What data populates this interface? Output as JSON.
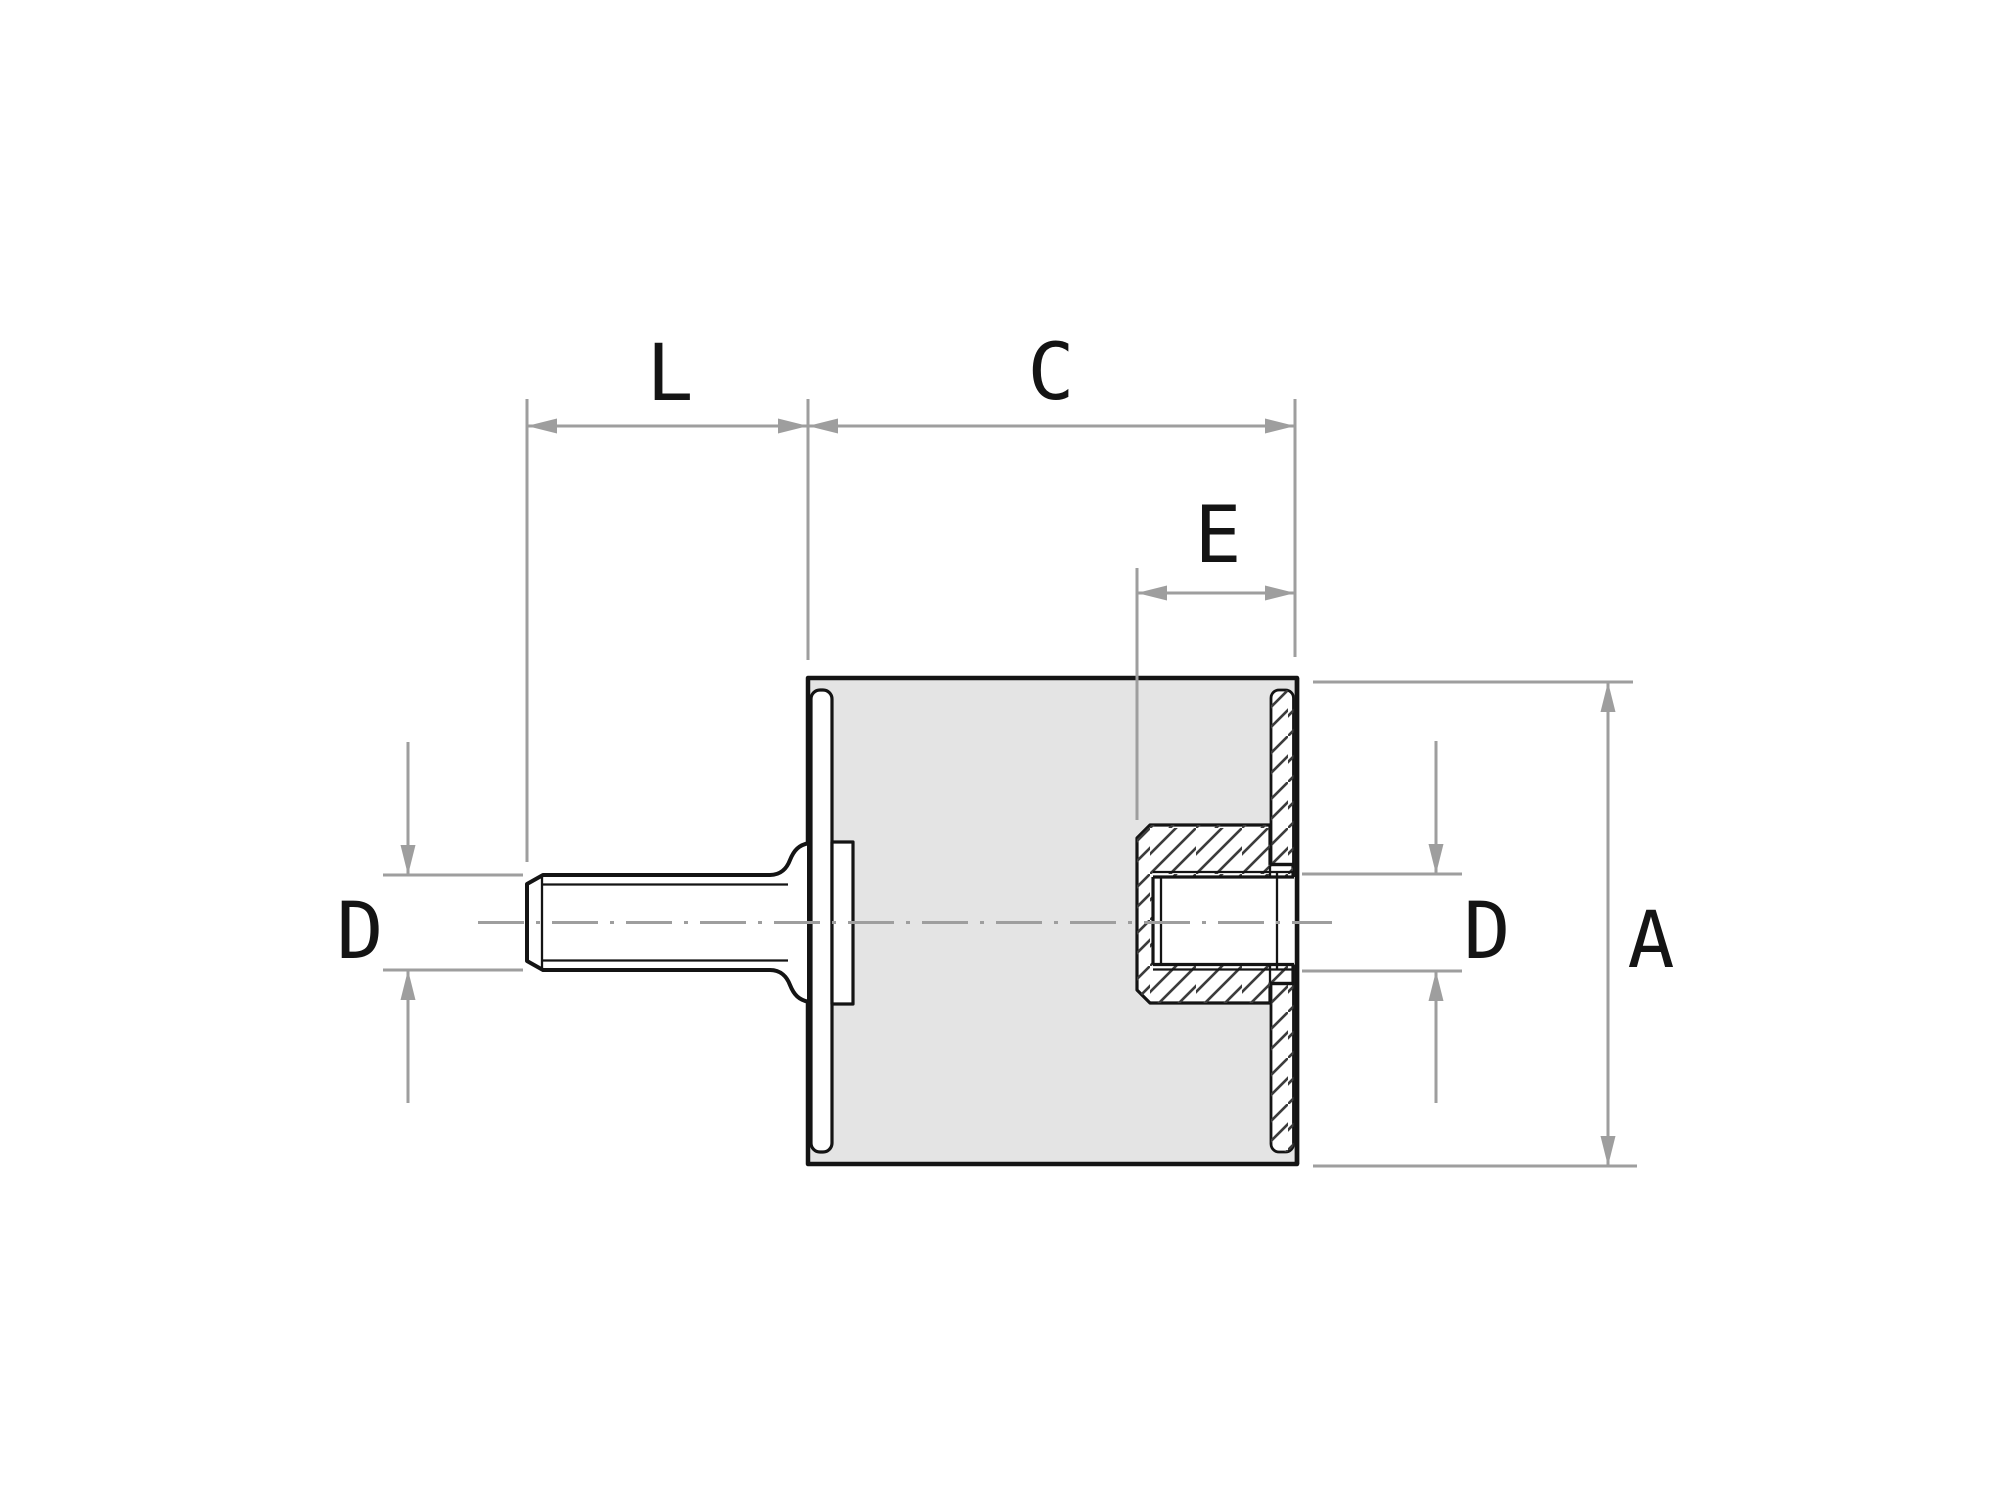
{
  "drawing": {
    "type": "engineering-section-view",
    "subject": "cylindrical rubber-metal vibration mount, male stud left / threaded insert right",
    "labels": {
      "L": "L",
      "C": "C",
      "E": "E",
      "D_left": "D",
      "D_right": "D",
      "A": "A"
    },
    "dimension_meaning": {
      "L": "stud thread length (left of body face)",
      "C": "body length (left face to right face)",
      "E": "thread insert depth from right face",
      "D_left": "stud thread diameter",
      "D_right": "tapped hole thread diameter",
      "A": "body diameter / height"
    }
  },
  "theme": {
    "background": "#ffffff",
    "outline": "#141414",
    "bodyFill": "#e4e4e4",
    "metalFill": "#ffffff",
    "dim": "#9e9e9e",
    "hatch": "#3c3c3c",
    "label": "#141414"
  }
}
